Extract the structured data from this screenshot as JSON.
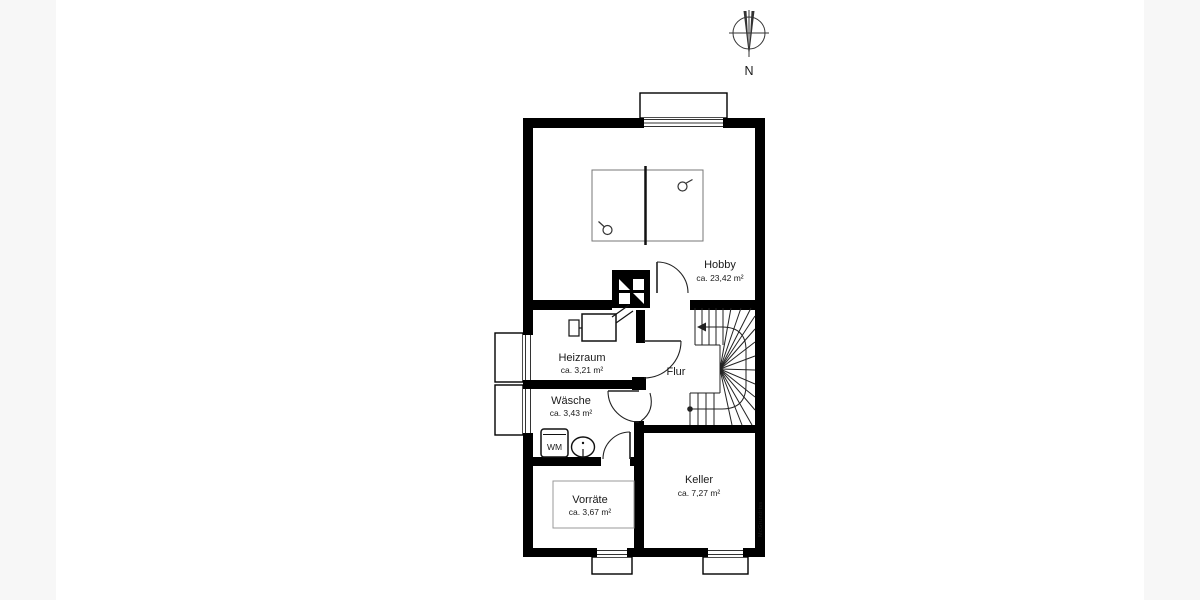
{
  "compass": {
    "label": "N"
  },
  "watermark": {
    "text": "McGrundriss"
  },
  "rooms": {
    "hobby": {
      "name": "Hobby",
      "area": "ca. 23,42 m²"
    },
    "heizraum": {
      "name": "Heizraum",
      "area": "ca. 3,21 m²"
    },
    "flur": {
      "name": "Flur"
    },
    "waesche": {
      "name": "Wäsche",
      "area": "ca. 3,43 m²"
    },
    "vorraete": {
      "name": "Vorräte",
      "area": "ca. 3,67 m²"
    },
    "keller": {
      "name": "Keller",
      "area": "ca. 7,27 m²"
    }
  },
  "fixtures": {
    "washing_machine": "WM"
  },
  "colors": {
    "wall": "#000000",
    "line": "#222222",
    "furniture": "#777777"
  }
}
